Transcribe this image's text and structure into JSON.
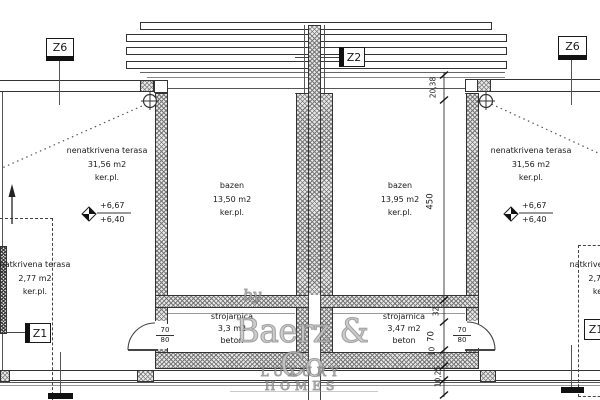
{
  "markers": {
    "z6": "Z6",
    "z2": "Z2",
    "z1": "Z1"
  },
  "rooms": {
    "terrace_left": {
      "name": "nenatkrivena terasa",
      "area": "31,56 m2",
      "finish": "ker.pl."
    },
    "terrace_right": {
      "name": "nenatkrivena terasa",
      "area": "31,56 m2",
      "finish": "ker.pl."
    },
    "pool_left": {
      "name": "bazen",
      "area": "13,50 m2",
      "finish": "ker.pl."
    },
    "pool_right": {
      "name": "bazen",
      "area": "13,95 m2",
      "finish": "ker.pl."
    },
    "plant_left": {
      "name": "strojarnica",
      "area": "3,3 m2",
      "finish": "beton"
    },
    "plant_right": {
      "name": "strojarnica",
      "area": "3,47 m2",
      "finish": "beton"
    },
    "covered_left": {
      "name": "natkrivena terasa",
      "area": "2,77 m2",
      "finish": "ker.pl."
    },
    "covered_right": {
      "name": "natkrivena terasa",
      "area": "2,77 m2",
      "finish": "ker.pl."
    }
  },
  "elevation": {
    "upper": "+6,67",
    "lower": "+6,40"
  },
  "dims": {
    "top_stack": "20,38",
    "pool_length": "450",
    "d32": "32",
    "d70": "70",
    "d10": "10",
    "bottom_stack": "10,25",
    "door_width": "70",
    "door_height": "80"
  },
  "watermark": {
    "prefix": "by",
    "brand": "Baerz & Co",
    "tagline": "LUXURY HOMES"
  },
  "colors": {
    "line": "#333333",
    "hatch": "#777777",
    "watermark": "#9a9a9a",
    "background": "#ffffff"
  }
}
